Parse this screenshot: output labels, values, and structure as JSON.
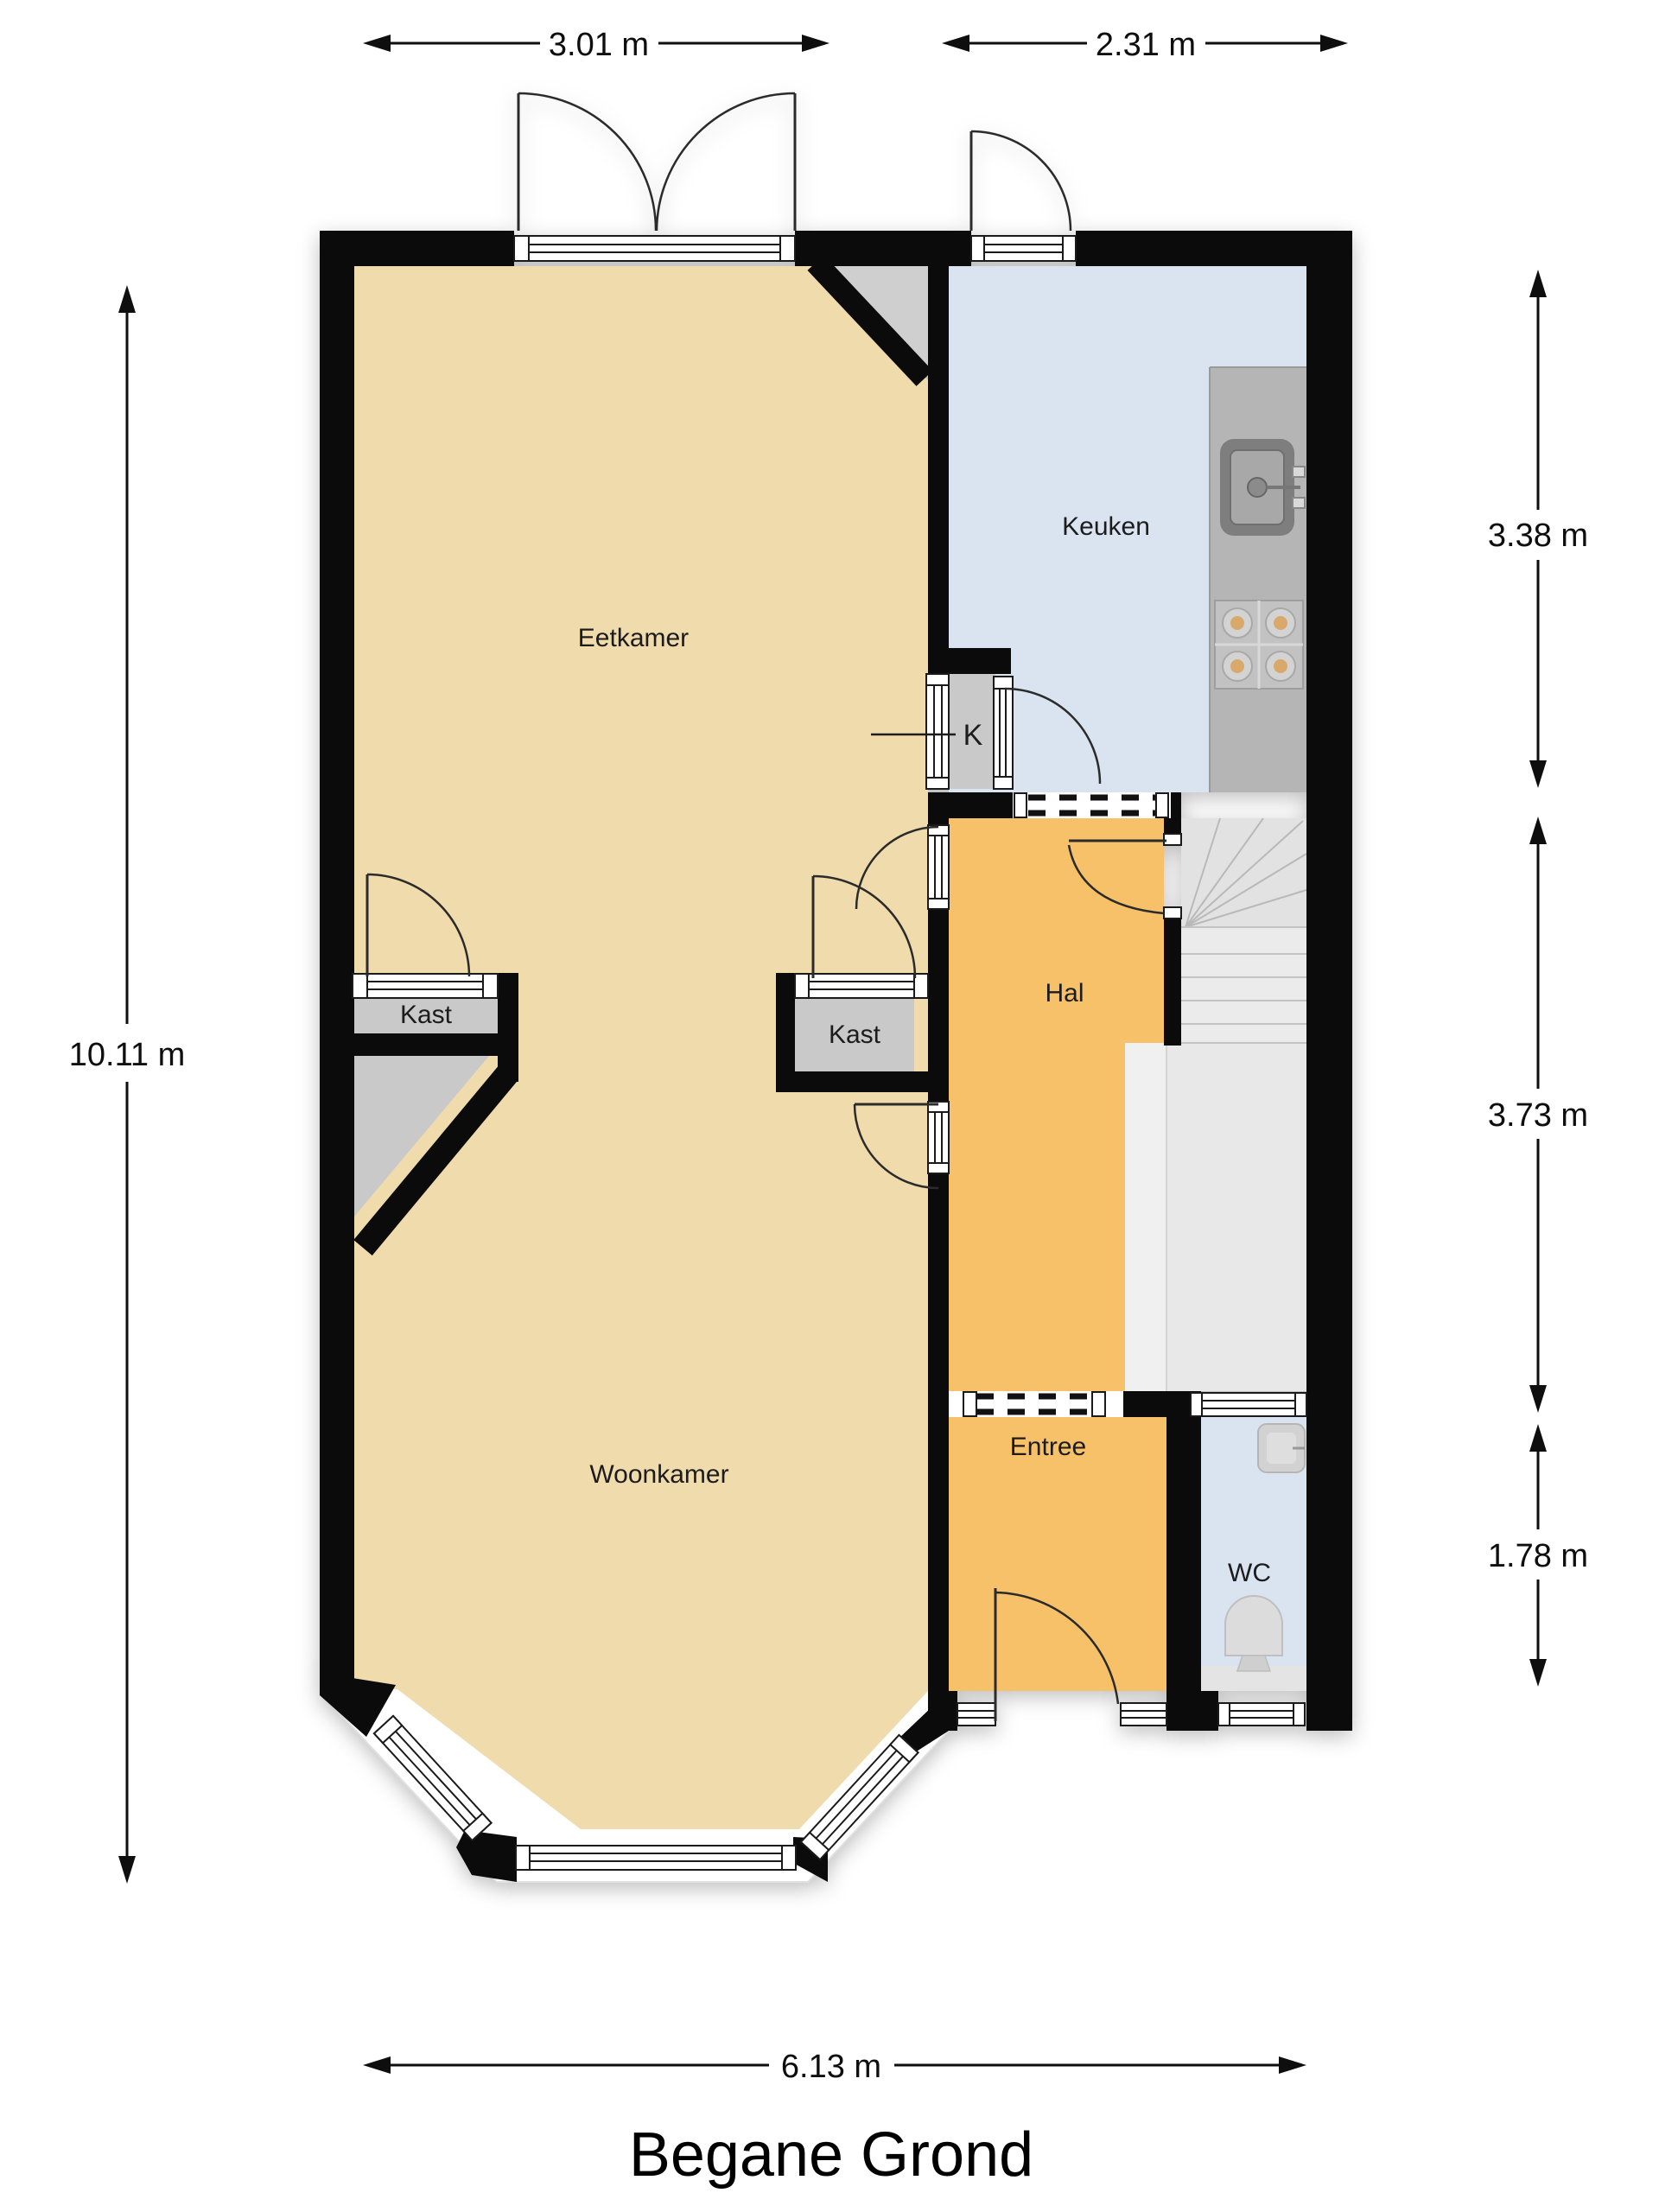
{
  "title": "Begane Grond",
  "rooms": {
    "eetkamer": {
      "label": "Eetkamer"
    },
    "keuken": {
      "label": "Keuken"
    },
    "kast_left": {
      "label": "Kast"
    },
    "kast_mid": {
      "label": "Kast"
    },
    "k_closet": {
      "label": "K"
    },
    "hal": {
      "label": "Hal"
    },
    "woonkamer": {
      "label": "Woonkamer"
    },
    "entree": {
      "label": "Entree"
    },
    "wc": {
      "label": "WC"
    }
  },
  "dimensions": {
    "top_left": "3.01 m",
    "top_right": "2.31 m",
    "left": "10.11 m",
    "right_top": "3.38 m",
    "right_mid": "3.73 m",
    "right_bottom": "1.78 m",
    "bottom": "6.13 m"
  },
  "icons": {
    "sink": "kitchen-sink-icon",
    "stove": "stove-burners-icon",
    "toilet": "toilet-icon",
    "basin": "hand-basin-icon",
    "stairs": "staircase-icon"
  },
  "colors": {
    "wall": "#0b0b0b",
    "floor_living": "#F0DBAC",
    "floor_hall": "#F6C169",
    "floor_kitchen": "#D9E4F0",
    "floor_wc": "#D9E4F0",
    "closet": "#C9C9C9",
    "closet_tri": "#CFCFCF",
    "counter": "#B5B5B5",
    "stairs": "#E2E2E2",
    "stairs_lower": "#EBEBEB",
    "landing": "#E8E8E8"
  }
}
